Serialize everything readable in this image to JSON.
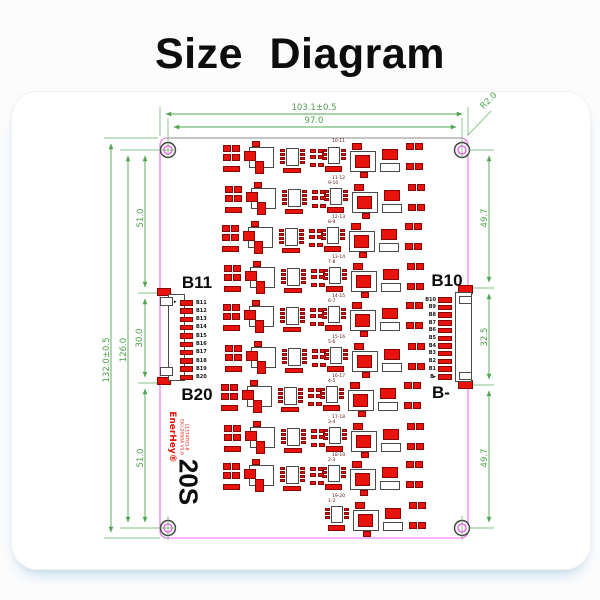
{
  "title": "Size Diagram",
  "board": {
    "dim_width_outer": "103.1±0.5",
    "dim_width_holes": "97.0",
    "corner_radius": "R2.0",
    "dim_height_outer": "132.0±0.5",
    "dim_height_holes": "126.0",
    "dim_left_top": "51.0",
    "dim_left_connector": "30.0",
    "dim_left_bottom": "51.0",
    "dim_right_top": "49.7",
    "dim_right_connector": "32.5",
    "dim_right_bottom": "49.7"
  },
  "left_connector": {
    "label_top": "B11",
    "label_bottom": "B20",
    "pin_marker": "►",
    "pins": [
      "B11",
      "B12",
      "B13",
      "B14",
      "B15",
      "B16",
      "B17",
      "B18",
      "B19",
      "B20"
    ]
  },
  "right_connector": {
    "label_top": "B10",
    "label_bottom": "B-",
    "pin_marker": "►",
    "pins": [
      "B10",
      "B9",
      "B8",
      "B7",
      "B6",
      "B5",
      "B4",
      "B3",
      "B2",
      "B1",
      "B-"
    ]
  },
  "silkscreen": {
    "brand": "EnerHey®",
    "model": "EK-L20S0A V1.0",
    "serial": "L1374T03-8",
    "cells": "20S"
  },
  "pair_labels": {
    "top": "10-11",
    "rows": [
      [
        "11-12",
        "9-10"
      ],
      [
        "12-13",
        "8-9"
      ],
      [
        "13-14",
        "7-8"
      ],
      [
        "14-15",
        "6-7"
      ],
      [
        "15-16",
        "5-6"
      ],
      [
        "16-17",
        "4-5"
      ],
      [
        "17-18",
        "3-4"
      ],
      [
        "18-19",
        "2-3"
      ],
      [
        "19-20",
        "1-2"
      ]
    ]
  },
  "colors": {
    "dimension": "#4d9f4d",
    "board_edge": "#ef6bef",
    "component_red": "#e8130c",
    "silkscreen_red": "#e8130c",
    "text": "#111111"
  }
}
